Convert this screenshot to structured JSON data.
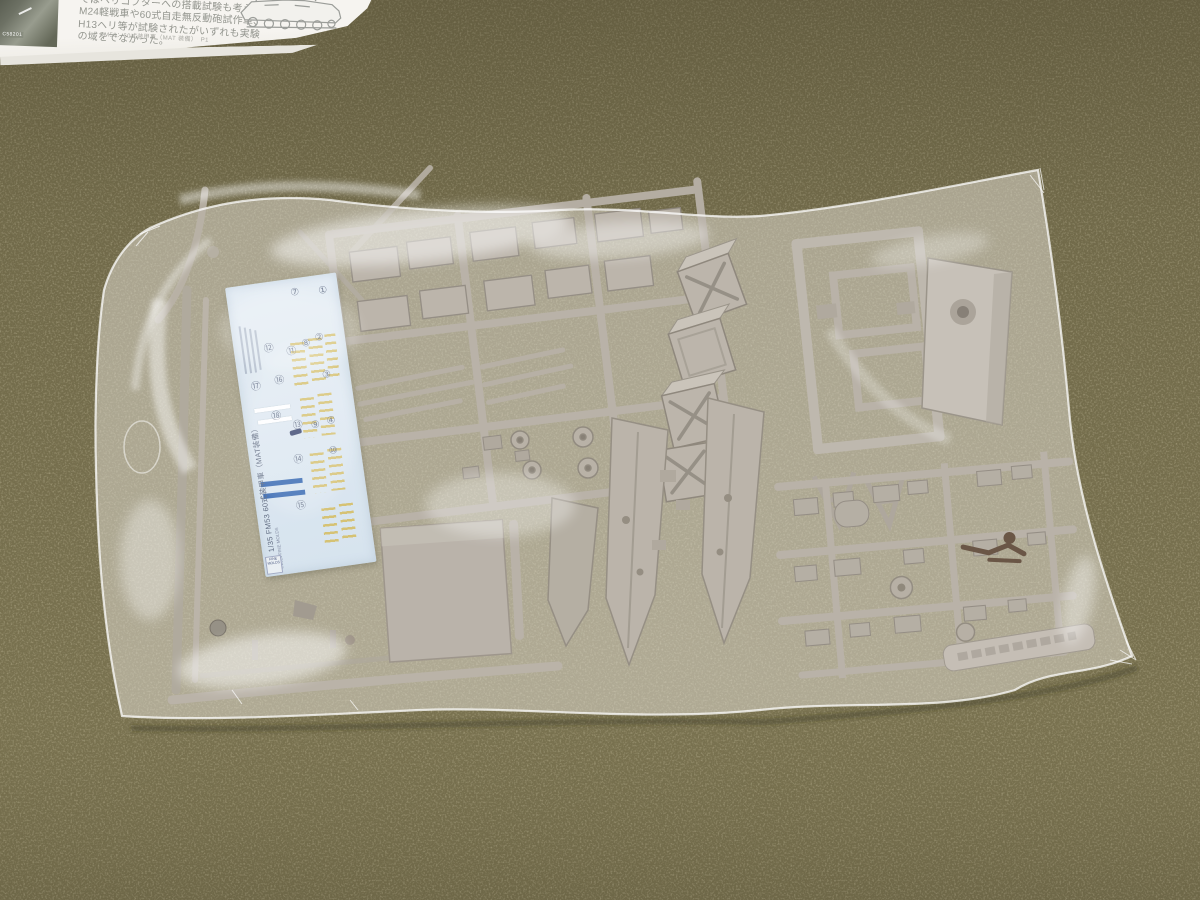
{
  "scene": {
    "subject": "Plastic model kit sprues and a decal sheet sealed in a clear bag, lying on olive woven fabric; instruction page visible at top-left",
    "colors": {
      "fabric": "#78704e",
      "fabric_dark": "#5e5840",
      "fabric_light": "#a59b76",
      "paper": "#f4f2ee",
      "paper_print": "#94968f",
      "plastic_part": "#b4ada2",
      "plastic_shadow": "#847d72",
      "plastic_highlight": "#d9d3c9",
      "bag_glare": "#ffffff",
      "decal_background": "#dde8f1",
      "decal_blue": "#2a5fae",
      "decal_yellow": "#d2ba5c",
      "dark_parts": "#5f4a38"
    }
  },
  "paper": {
    "lines": [
      "ではヘリコプターへの搭載試験も考えられ、",
      "M24軽戦車や60式自走無反動砲試作車、",
      "H13ヘリ等が試験されたがいずれも実験",
      "の域をでなかった。"
    ],
    "caption": "FM53：60式装甲車（MAT 装備）　P1",
    "photo_label": "C58201"
  },
  "decal": {
    "side_label": "1/35 FM53 60式装甲車（MAT装備）",
    "copyright": "©2011 FINE MOLDS",
    "brand": "FINE MOLDS",
    "numbers": [
      "①",
      "②",
      "③",
      "④",
      "⑦",
      "⑧",
      "⑨",
      "⑩",
      "⑪",
      "⑫",
      "⑬",
      "⑭",
      "⑮",
      "⑯",
      "⑰",
      "⑱"
    ]
  }
}
